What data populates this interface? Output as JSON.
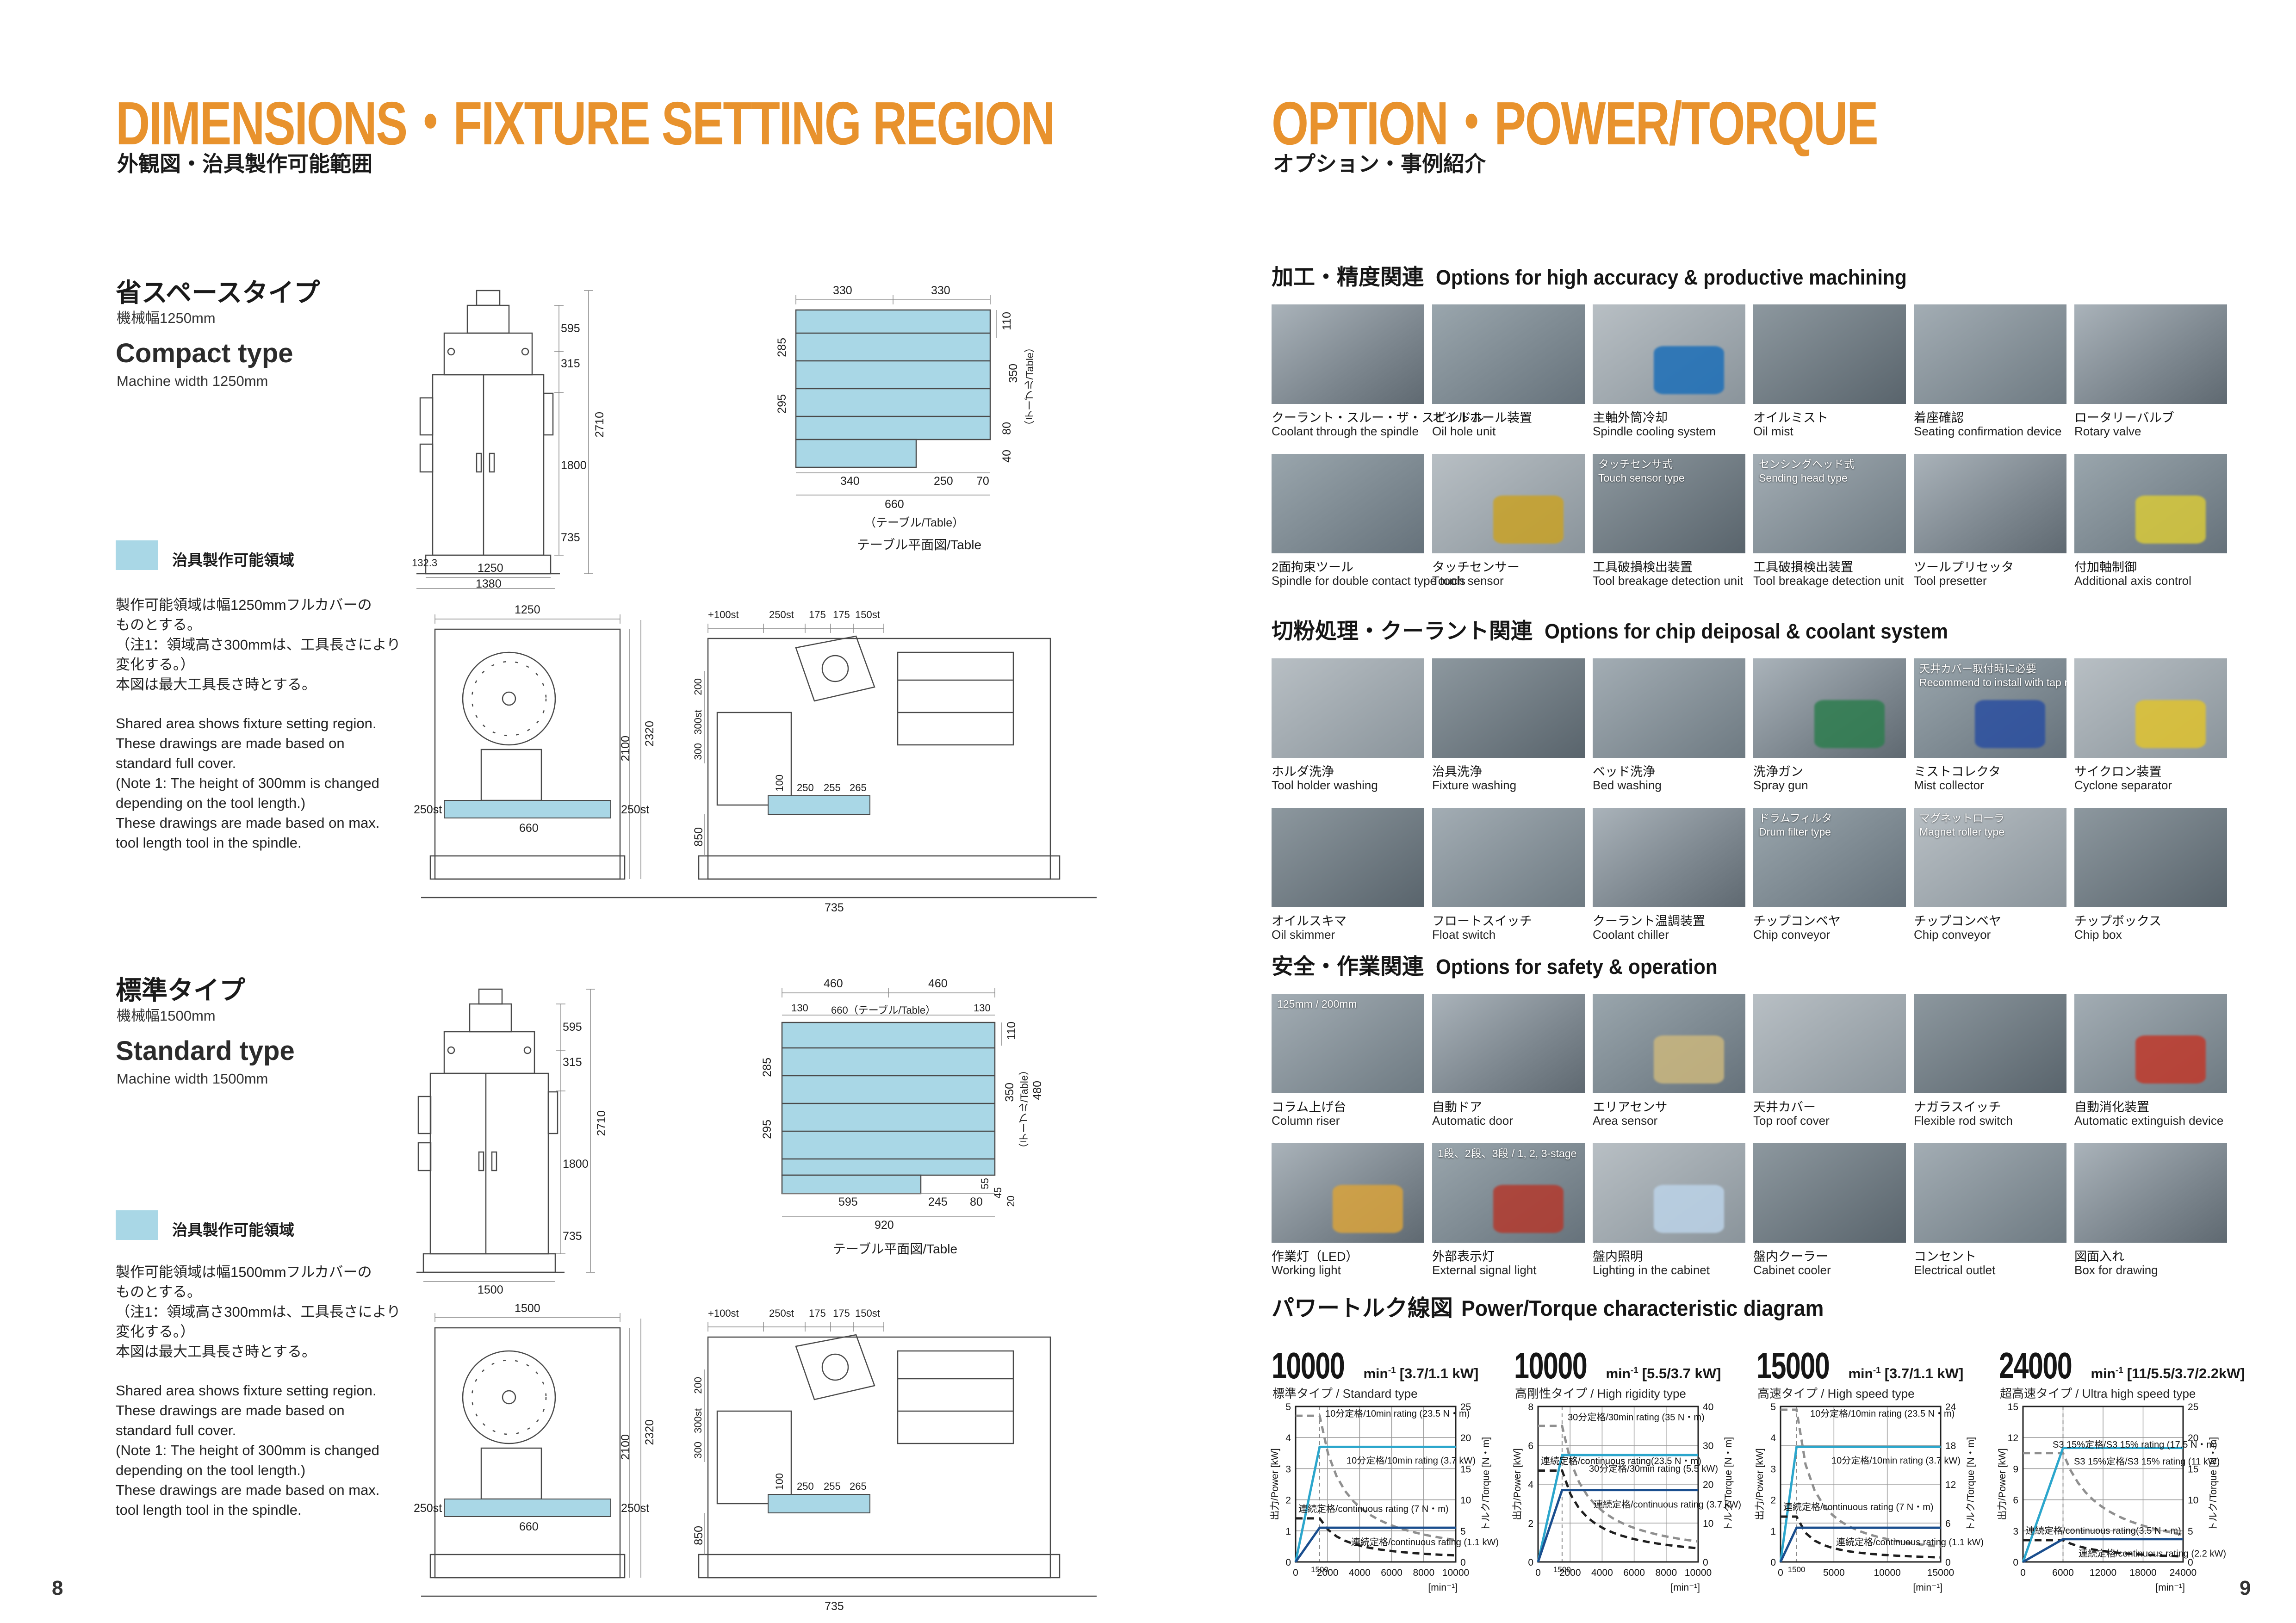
{
  "colors": {
    "accent": "#E8922D",
    "fixture_region": "#A9D7E6",
    "chart_power_rated": "#2BA6CC",
    "chart_power_cont": "#1A4E8E",
    "chart_torque_rated": "#8F8F8F",
    "chart_torque_cont": "#1F1F1F"
  },
  "left_page": {
    "title": "DIMENSIONS・FIXTURE SETTING REGION",
    "subtitle_jp": "外観図・治具製作可能範囲",
    "page_number": "8",
    "legend_label": "治具製作可能領域",
    "table_caption": "テーブル平面図/Table",
    "sections": [
      {
        "type_jp": "省スペースタイプ",
        "width_jp": "機械幅1250mm",
        "type_en": "Compact type",
        "width_en": "Machine width 1250mm",
        "notes_jp": [
          "製作可能領域は幅1250mmフルカバーの",
          "ものとする。",
          "（注1：領域高さ300mmは、工具長さにより",
          "変化する。）",
          "本図は最大工具長さ時とする。"
        ],
        "notes_en": [
          "Shared area shows fixture setting region.",
          "These drawings are made based on",
          "standard full cover.",
          "(Note 1: The height of 300mm is changed",
          "depending on the tool length.)",
          "These drawings are made based on max.",
          "tool length tool in the spindle."
        ]
      },
      {
        "type_jp": "標準タイプ",
        "width_jp": "機械幅1500mm",
        "type_en": "Standard type",
        "width_en": "Machine width 1500mm",
        "notes_jp": [
          "製作可能領域は幅1500mmフルカバーの",
          "ものとする。",
          "（注1：領域高さ300mmは、工具長さにより",
          "変化する。）",
          "本図は最大工具長さ時とする。"
        ],
        "notes_en": [
          "Shared area shows fixture setting region.",
          "These drawings are made based on",
          "standard full cover.",
          "(Note 1: The height of 300mm is changed",
          "depending on the tool length.)",
          "These drawings are made based on max.",
          "tool length tool in the spindle."
        ]
      }
    ],
    "drawings": {
      "compact_front_dims": [
        "595",
        "315",
        "2710",
        "1800",
        "735",
        "132.3",
        "1250",
        "1380"
      ],
      "compact_plan_dims": [
        "330",
        "330",
        "110",
        "285",
        "295",
        "350",
        "（テーブル/Table）",
        "80",
        "40",
        "340",
        "250",
        "70",
        "660",
        "（テーブル/Table）"
      ],
      "compact_side_dims": [
        "1250",
        "250st",
        "660",
        "250st",
        "2320",
        "2100",
        "+100st",
        "250st",
        "175",
        "175",
        "150st",
        "200",
        "300st",
        "300",
        "100",
        "250",
        "255",
        "265",
        "850",
        "735"
      ],
      "standard_plan_dims": [
        "460",
        "460",
        "130",
        "660（テーブル/Table）",
        "130",
        "110",
        "285",
        "295",
        "350",
        "（テーブル/Table）",
        "480",
        "55",
        "45",
        "20",
        "595",
        "245",
        "80",
        "920"
      ],
      "standard_front_dims": [
        "595",
        "315",
        "2710",
        "1800",
        "735",
        "1500"
      ],
      "standard_side_dims": [
        "1500",
        "250st",
        "660",
        "250st",
        "2320",
        "2100",
        "+100st",
        "250st",
        "175",
        "175",
        "150st",
        "200",
        "300st",
        "300",
        "100",
        "250",
        "255",
        "265",
        "850",
        "735"
      ]
    }
  },
  "right_page": {
    "title": "OPTION・POWER/TORQUE",
    "subtitle_jp": "オプション・事例紹介",
    "page_number": "9",
    "sections": [
      {
        "title_jp": "加工・精度関連",
        "title_en": "Options for high accuracy & productive machining",
        "rows": [
          [
            {
              "jp": "クーラント・スルー・ザ・スピンドル",
              "en": "Coolant through the spindle"
            },
            {
              "jp": "オイルホール装置",
              "en": "Oil hole unit"
            },
            {
              "jp": "主軸外筒冷却",
              "en": "Spindle cooling system",
              "accent": "#1d6fb8"
            },
            {
              "jp": "オイルミスト",
              "en": "Oil mist"
            },
            {
              "jp": "着座確認",
              "en": "Seating confirmation device"
            },
            {
              "jp": "ロータリーバルブ",
              "en": "Rotary valve"
            }
          ],
          [
            {
              "jp": "2面拘束ツール",
              "en": "Spindle for double contact type tools"
            },
            {
              "jp": "タッチセンサー",
              "en": "Touch sensor",
              "accent": "#c9a227"
            },
            {
              "jp": "工具破損検出装置",
              "en": "Tool breakage detection unit",
              "overlay": [
                "タッチセンサ式",
                "Touch sensor type"
              ]
            },
            {
              "jp": "工具破損検出装置",
              "en": "Tool breakage detection unit",
              "overlay": [
                "センシングヘッド式",
                "Sending head type"
              ]
            },
            {
              "jp": "ツールプリセッタ",
              "en": "Tool presetter"
            },
            {
              "jp": "付加軸制御",
              "en": "Additional axis control",
              "accent": "#d8c93a"
            }
          ]
        ]
      },
      {
        "title_jp": "切粉処理・クーラント関連",
        "title_en": "Options for chip deiposal & coolant system",
        "rows": [
          [
            {
              "jp": "ホルダ洗浄",
              "en": "Tool holder washing"
            },
            {
              "jp": "治具洗浄",
              "en": "Fixture washing"
            },
            {
              "jp": "ベッド洗浄",
              "en": "Bed washing"
            },
            {
              "jp": "洗浄ガン",
              "en": "Spray gun",
              "accent": "#2e7d4f"
            },
            {
              "jp": "ミストコレクタ",
              "en": "Mist collector",
              "overlay": [
                "天井カバー取付時に必要",
                "Recommend to install with tap roof cover."
              ],
              "accent": "#2b4fa0"
            },
            {
              "jp": "サイクロン装置",
              "en": "Cyclone separator",
              "accent": "#e0c32f"
            }
          ],
          [
            {
              "jp": "オイルスキマ",
              "en": "Oil skimmer"
            },
            {
              "jp": "フロートスイッチ",
              "en": "Float switch"
            },
            {
              "jp": "クーラント温調装置",
              "en": "Coolant chiller"
            },
            {
              "jp": "チップコンベヤ",
              "en": "Chip conveyor",
              "overlay": [
                "ドラムフィルタ",
                "Drum filter type"
              ]
            },
            {
              "jp": "チップコンベヤ",
              "en": "Chip conveyor",
              "overlay": [
                "マグネットローラ",
                "Magnet roller type"
              ]
            },
            {
              "jp": "チップボックス",
              "en": "Chip box"
            }
          ]
        ]
      },
      {
        "title_jp": "安全・作業関連",
        "title_en": "Options for safety & operation",
        "rows": [
          [
            {
              "jp": "コラム上げ台",
              "en": "Column riser",
              "overlay": [
                "125mm / 200mm"
              ]
            },
            {
              "jp": "自動ドア",
              "en": "Automatic door"
            },
            {
              "jp": "エリアセンサ",
              "en": "Area sensor",
              "accent": "#cbb77e"
            },
            {
              "jp": "天井カバー",
              "en": "Top roof cover"
            },
            {
              "jp": "ナガラスイッチ",
              "en": "Flexible rod switch"
            },
            {
              "jp": "自動消化装置",
              "en": "Automatic extinguish device",
              "accent": "#c0392b"
            }
          ],
          [
            {
              "jp": "作業灯（LED）",
              "en": "Working light",
              "accent": "#d9a33c"
            },
            {
              "jp": "外部表示灯",
              "en": "External signal light",
              "overlay": [
                "1段、2段、3段 / 1, 2, 3-stage"
              ],
              "accent": "#b33a2e"
            },
            {
              "jp": "盤内照明",
              "en": "Lighting in the cabinet",
              "accent": "#bcd3e8"
            },
            {
              "jp": "盤内クーラー",
              "en": "Cabinet cooler"
            },
            {
              "jp": "コンセント",
              "en": "Electrical outlet"
            },
            {
              "jp": "図面入れ",
              "en": "Box for drawing"
            }
          ]
        ]
      }
    ],
    "power_section": {
      "title_jp": "パワートルク線図",
      "title_en": "Power/Torque characteristic diagram"
    }
  },
  "chart_data": [
    {
      "type": "line",
      "title_speed": "10000",
      "title_unit": "min",
      "title_unit_sup": "-1",
      "title_kw": "[3.7/1.1 kW]",
      "subtitle": "標準タイプ / Standard type",
      "xlabel": "[min⁻¹]",
      "x_max": 10000,
      "knee": 1500,
      "x_ticks": [
        0,
        1500,
        2000,
        4000,
        6000,
        8000,
        10000
      ],
      "x_grid": [
        2000,
        4000,
        6000,
        8000
      ],
      "power_axis": {
        "label": "出力/Power  [kW]",
        "max": 5,
        "ticks": [
          0,
          1,
          2,
          3,
          4,
          5
        ]
      },
      "torque_axis": {
        "label": "トルク/Torque  [N・m]",
        "max": 25,
        "ticks": [
          0,
          5,
          10,
          15,
          20,
          25
        ]
      },
      "series": [
        {
          "name": "10分定格/10min rating (23.5 N・m)",
          "axis": "torque",
          "value": 23.5,
          "color": "#8F8F8F",
          "dash": true
        },
        {
          "name": "10分定格/10min rating (3.7 kW)",
          "axis": "power",
          "value": 3.7,
          "color": "#2BA6CC",
          "dash": false
        },
        {
          "name": "連続定格/continuous rating (7 N・m)",
          "axis": "torque",
          "value": 7,
          "color": "#1F1F1F",
          "dash": true
        },
        {
          "name": "連続定格/continuous rating (1.1 kW)",
          "axis": "power",
          "value": 1.1,
          "color": "#1A4E8E",
          "dash": false
        }
      ]
    },
    {
      "type": "line",
      "title_speed": "10000",
      "title_unit": "min",
      "title_unit_sup": "-1",
      "title_kw": "[5.5/3.7 kW]",
      "subtitle": "高剛性タイプ / High rigidity type",
      "xlabel": "[min⁻¹]",
      "x_max": 10000,
      "knee": 1500,
      "x_ticks": [
        0,
        1500,
        2000,
        4000,
        6000,
        8000,
        10000
      ],
      "x_grid": [
        2000,
        4000,
        6000,
        8000
      ],
      "power_axis": {
        "label": "出力/Power  [kW]",
        "max": 8,
        "ticks": [
          0,
          2,
          4,
          6,
          8
        ]
      },
      "torque_axis": {
        "label": "トルク/Torque  [N・m]",
        "max": 40,
        "ticks": [
          0,
          10,
          20,
          30,
          40
        ]
      },
      "series": [
        {
          "name": "30分定格/30min rating (35 N・m)",
          "axis": "torque",
          "value": 35,
          "color": "#8F8F8F",
          "dash": true
        },
        {
          "name": "30分定格/30min rating (5.5 kW)",
          "axis": "power",
          "value": 5.5,
          "color": "#2BA6CC",
          "dash": false
        },
        {
          "name": "連続定格/continuous rating(23.5 N・m)",
          "axis": "torque",
          "value": 23.5,
          "color": "#1F1F1F",
          "dash": true
        },
        {
          "name": "連続定格/continuous rating (3.7 kW)",
          "axis": "power",
          "value": 3.7,
          "color": "#1A4E8E",
          "dash": false
        }
      ]
    },
    {
      "type": "line",
      "title_speed": "15000",
      "title_unit": "min",
      "title_unit_sup": "-1",
      "title_kw": "[3.7/1.1 kW]",
      "subtitle": "高速タイプ / High speed type",
      "xlabel": "[min⁻¹]",
      "x_max": 15000,
      "knee": 1500,
      "x_ticks": [
        0,
        1500,
        5000,
        10000,
        15000
      ],
      "x_grid": [
        5000,
        10000
      ],
      "power_axis": {
        "label": "出力/Power  [kW]",
        "max": 5,
        "ticks": [
          0,
          1,
          2,
          3,
          4,
          5
        ]
      },
      "torque_axis": {
        "label": "トルク/Torque  [N・m]",
        "max": 24,
        "ticks": [
          0,
          6,
          12,
          18,
          24
        ]
      },
      "series": [
        {
          "name": "10分定格/10min rating (23.5 N・m)",
          "axis": "torque",
          "value": 23.5,
          "color": "#8F8F8F",
          "dash": true
        },
        {
          "name": "10分定格/10min rating (3.7 kW)",
          "axis": "power",
          "value": 3.7,
          "color": "#2BA6CC",
          "dash": false
        },
        {
          "name": "連続定格/continuous rating (7 N・m)",
          "axis": "torque",
          "value": 7,
          "color": "#1F1F1F",
          "dash": true
        },
        {
          "name": "連続定格/continuous rating (1.1 kW)",
          "axis": "power",
          "value": 1.1,
          "color": "#1A4E8E",
          "dash": false
        }
      ]
    },
    {
      "type": "line",
      "title_speed": "24000",
      "title_unit": "min",
      "title_unit_sup": "-1",
      "title_kw": "[11/5.5/3.7/2.2kW]",
      "subtitle": "超高速タイプ / Ultra high speed type",
      "xlabel": "[min⁻¹]",
      "x_max": 24000,
      "knee": 6000,
      "x_ticks": [
        0,
        6000,
        12000,
        18000,
        24000
      ],
      "x_grid": [
        6000,
        12000,
        18000
      ],
      "power_axis": {
        "label": "出力/Power  [kW]",
        "max": 15,
        "ticks": [
          0,
          3,
          6,
          9,
          12,
          15
        ]
      },
      "torque_axis": {
        "label": "トルク/Torque  [N・m]",
        "max": 25,
        "ticks": [
          0,
          5,
          10,
          15,
          20,
          25
        ]
      },
      "series": [
        {
          "name": "S3 15%定格/S3 15% rating (17.5 N・m)",
          "axis": "torque",
          "value": 17.5,
          "color": "#8F8F8F",
          "dash": true
        },
        {
          "name": "S3 15%定格/S3 15% rating (11 kW)",
          "axis": "power",
          "value": 11,
          "color": "#2BA6CC",
          "dash": false
        },
        {
          "name": "連続定格/continuous rating(3.5 N・m)",
          "axis": "torque",
          "value": 3.5,
          "color": "#1F1F1F",
          "dash": true
        },
        {
          "name": "連続定格/continuous rating (2.2 kW)",
          "axis": "power",
          "value": 2.2,
          "color": "#1A4E8E",
          "dash": false
        }
      ]
    }
  ]
}
